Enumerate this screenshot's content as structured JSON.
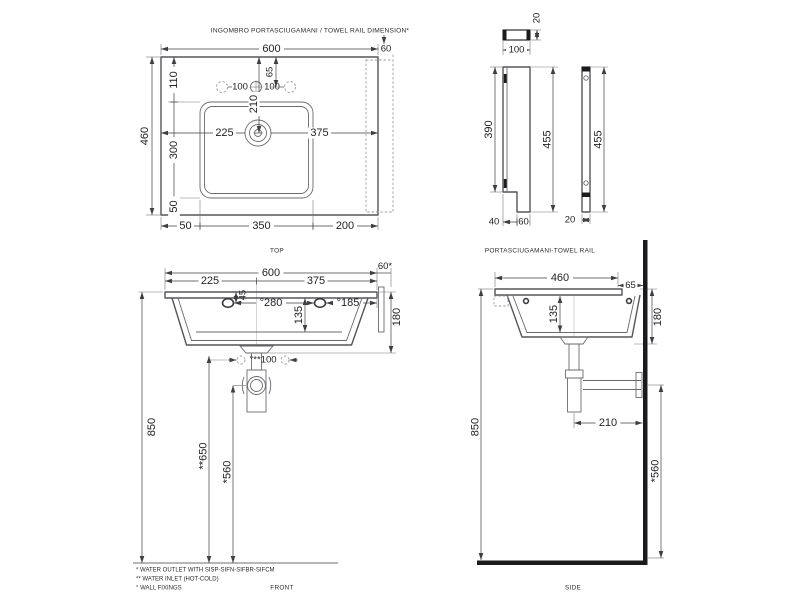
{
  "header_note": "INGOMBRO PORTASCIUGAMANI / TOWEL RAIL DIMENSION*",
  "top_view": {
    "caption": "TOP",
    "overall_width": "600",
    "towel_rail_offset": "60",
    "overall_depth": "460",
    "bowl_depth": "300",
    "deck_offset": "110",
    "front_offset": "50",
    "bowl_left_offset": "50",
    "bowl_width": "350",
    "bowl_right_offset": "200",
    "drain_from_left": "225",
    "drain_from_right": "375",
    "tap_hole_left": "100",
    "tap_hole_right": "100",
    "tap_holes_from_back": "65",
    "drain_from_back": "210"
  },
  "rail_views": {
    "caption": "PORTASCIUGAMANI-TOWEL RAIL",
    "top_thickness": "20",
    "top_width": "100",
    "plate_height": "390",
    "overall_height": "455",
    "side_overall_height": "455",
    "bottom_notch": "40",
    "bottom_tab": "60",
    "side_thickness": "20"
  },
  "front_view": {
    "caption": "FRONT",
    "overall_width": "600",
    "center_from_left": "225",
    "center_from_right": "375",
    "towel_rail_offset": "60*",
    "fixing_depth": "°45",
    "fixing_span": "°280",
    "fixing_from_right": "°185",
    "bowl_inner_depth": "135",
    "front_height": "180",
    "inlet_spacing": "°**100",
    "rim_height": "850",
    "inlet_height": "**650",
    "outlet_height": "*560"
  },
  "side_view": {
    "caption": "SIDE",
    "overall_depth": "460",
    "back_clearance": "65",
    "bowl_inner_depth": "135",
    "front_height": "180",
    "trap_from_wall": "210",
    "rim_height": "850",
    "outlet_height": "*560"
  },
  "footnotes": {
    "outlet": "* WATER OUTLET WITH SISP-SIFN-SIFBR-SIFCM",
    "inlet": "** WATER INLET  (HOT-COLD)",
    "fixings": "° WALL FIXINGS"
  },
  "colors": {
    "line": "#55565A",
    "text": "#1F2022",
    "solid": "#1B1B1D",
    "dashed": "#9B9B9D"
  }
}
